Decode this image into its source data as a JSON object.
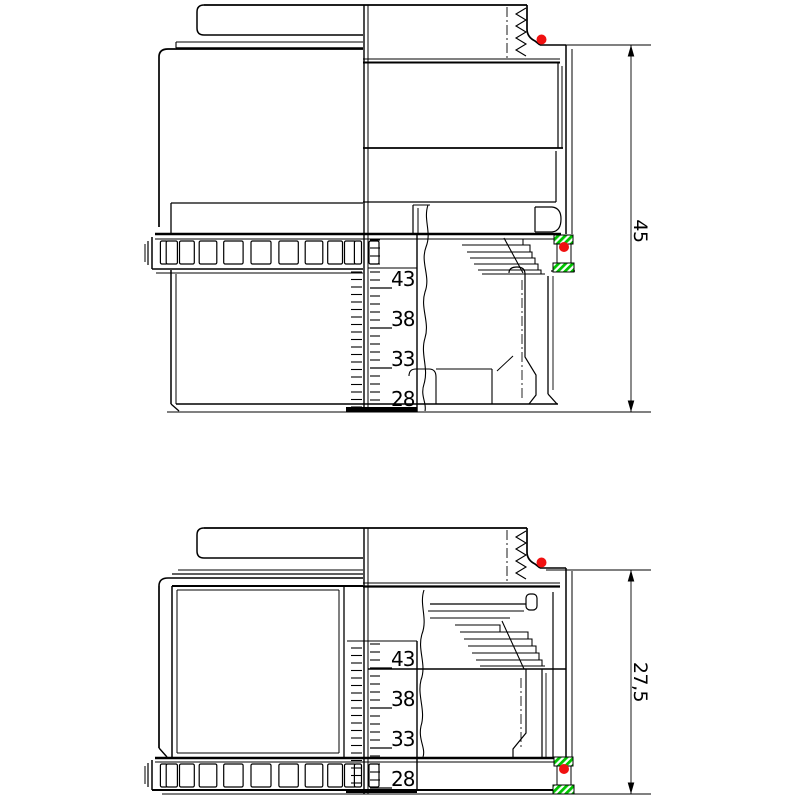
{
  "drawing": {
    "kind": "lens-barrel-section-technical-drawing",
    "views": [
      {
        "name": "extended-section-view",
        "dimension_label": "45",
        "scale_labels": [
          "43",
          "38",
          "33",
          "28"
        ]
      },
      {
        "name": "collapsed-section-view",
        "dimension_label": "27,5",
        "scale_labels": [
          "43",
          "38",
          "33",
          "28"
        ]
      }
    ],
    "colors": {
      "line": "#000000",
      "background": "#ffffff",
      "seal_hatch_green": "#00c400",
      "marker_red": "#f01010"
    }
  }
}
